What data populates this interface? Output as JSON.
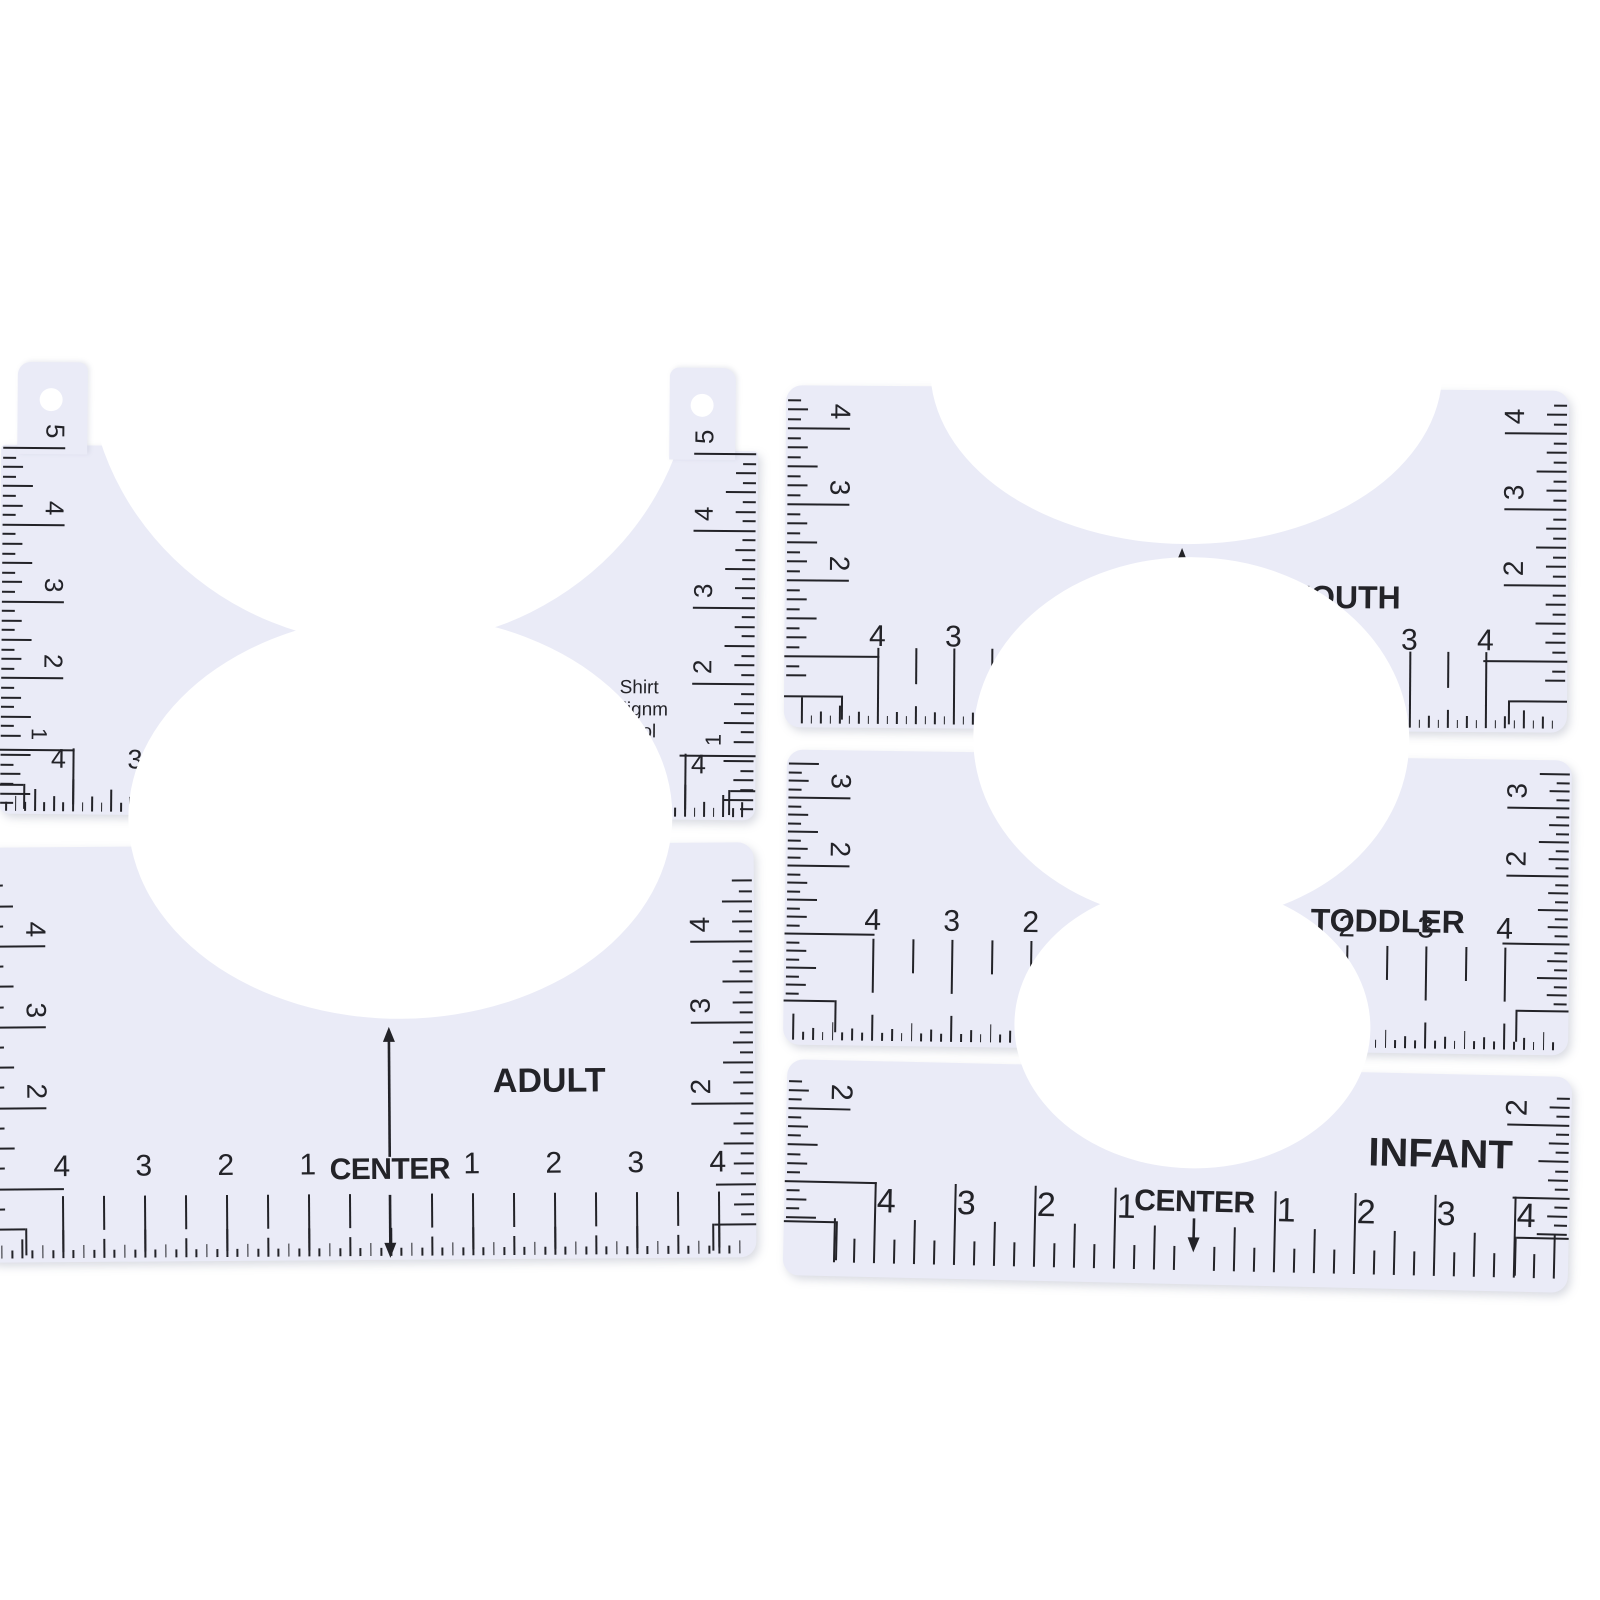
{
  "colors": {
    "background": "#ffffff",
    "ruler_body": "#eaebf7",
    "ink": "#232328"
  },
  "rulers": {
    "shirt_tool": {
      "center_label": "CENTER",
      "tool_name_lines": [
        "Shirt",
        "Alignm",
        "Tool"
      ],
      "units_label": "INCHES",
      "zero_label": "0",
      "left_scale": [
        "5",
        "4",
        "3",
        "2"
      ],
      "right_scale": [
        "5",
        "4",
        "3",
        "2"
      ],
      "left_corner_number": "1",
      "right_corner_number": "1",
      "bottom_left_numbers": [
        "4",
        "3",
        "2",
        "1"
      ],
      "bottom_right_numbers": [
        "1",
        "2",
        "3",
        "4"
      ]
    },
    "youth": {
      "size_label": "YOUTH",
      "center_label": "CENTER",
      "left_scale": [
        "4",
        "3",
        "2"
      ],
      "right_scale": [
        "4",
        "3",
        "2"
      ],
      "bottom_left_numbers": [
        "4",
        "3",
        "2",
        "1"
      ],
      "bottom_right_numbers": [
        "1",
        "2",
        "3",
        "4"
      ]
    },
    "toddler": {
      "size_label": "TODDLER",
      "center_label": "CENTER",
      "left_scale": [
        "3",
        "2"
      ],
      "right_scale": [
        "3",
        "2"
      ],
      "bottom_left_numbers": [
        "4",
        "3",
        "2",
        "1"
      ],
      "bottom_right_numbers": [
        "1",
        "2",
        "3",
        "4"
      ]
    },
    "adult": {
      "size_label": "ADULT",
      "center_label": "CENTER",
      "left_scale": [
        "4",
        "3",
        "2"
      ],
      "right_scale": [
        "4",
        "3",
        "2"
      ],
      "bottom_left_numbers": [
        "4",
        "3",
        "2",
        "1"
      ],
      "bottom_right_numbers": [
        "1",
        "2",
        "3",
        "4"
      ]
    },
    "infant": {
      "size_label": "INFANT",
      "center_label": "CENTER",
      "left_scale": [
        "2"
      ],
      "right_scale": [
        "2"
      ],
      "bottom_left_numbers": [
        "4",
        "3",
        "2",
        "1"
      ],
      "bottom_right_numbers": [
        "1",
        "2",
        "3",
        "4"
      ]
    }
  }
}
